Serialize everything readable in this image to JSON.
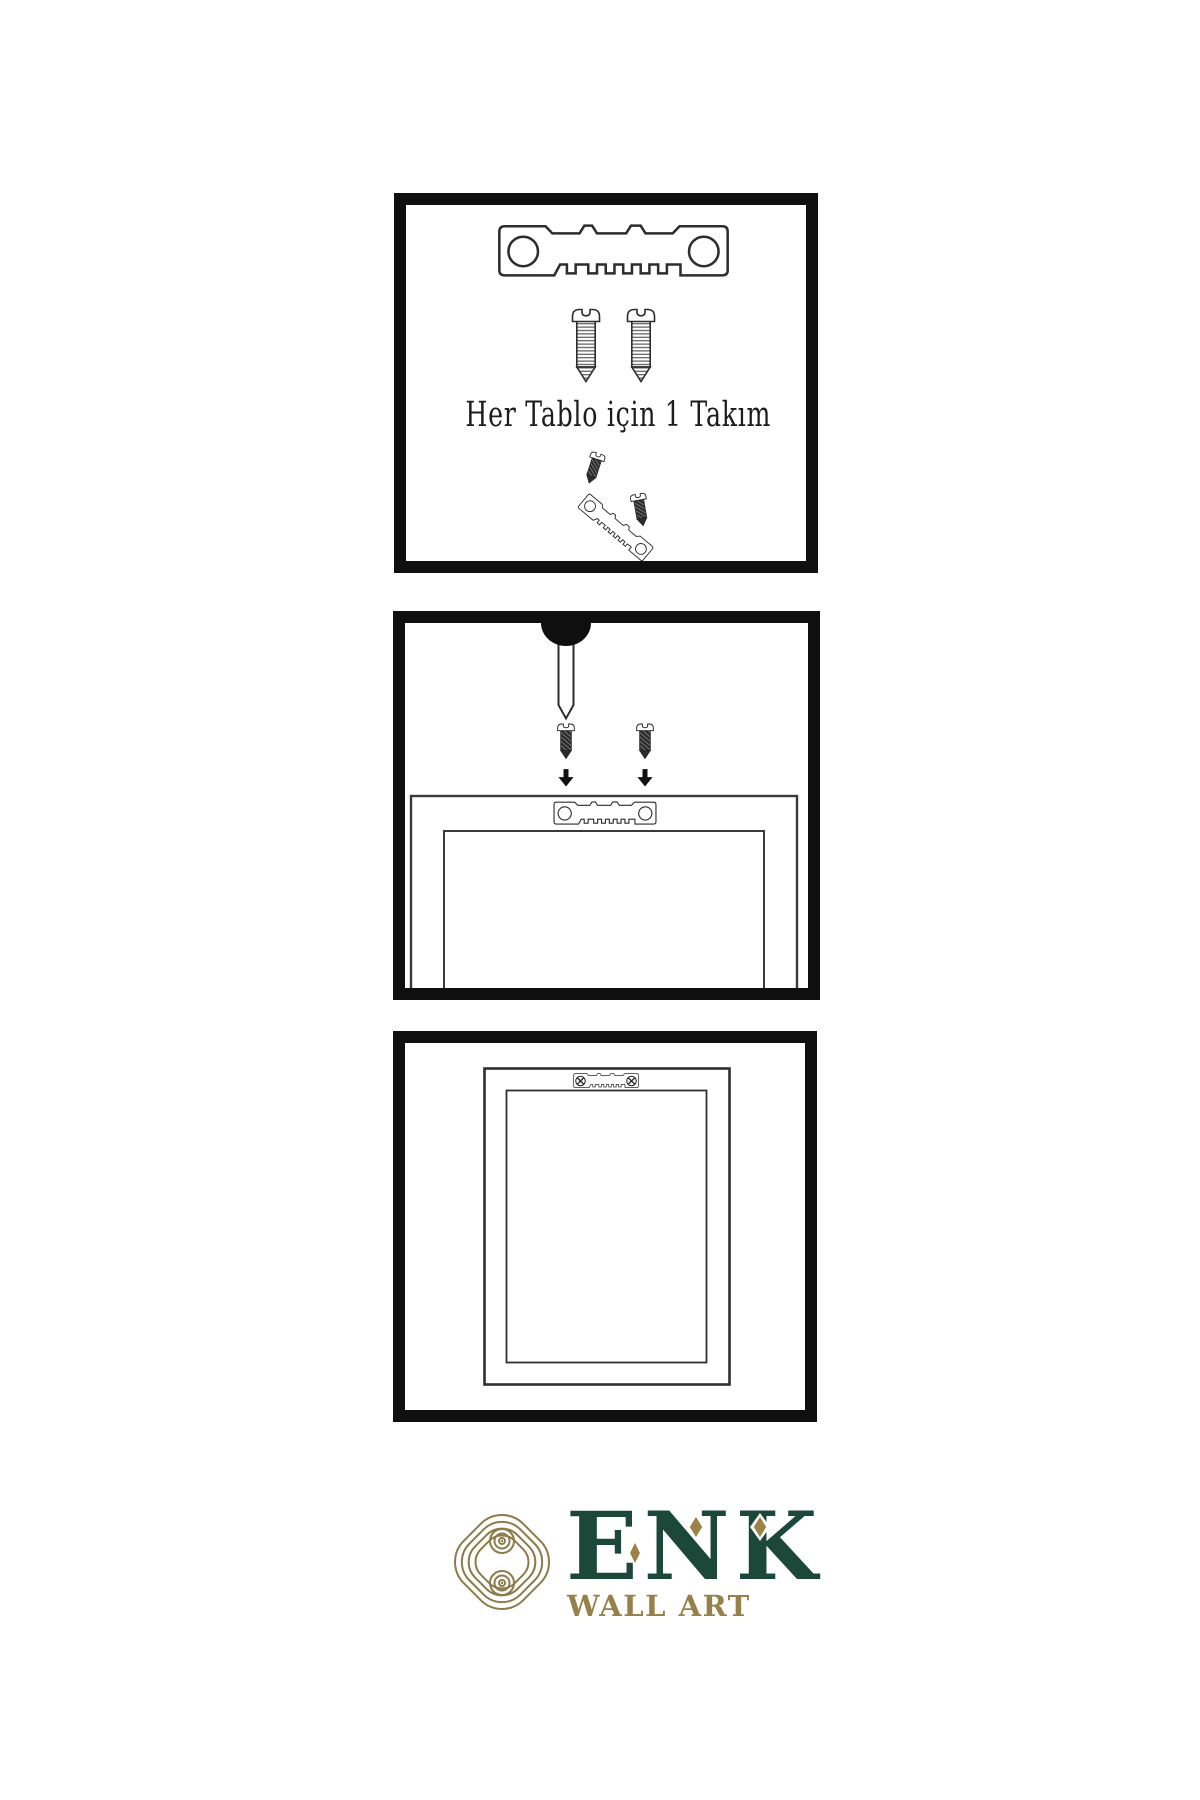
{
  "document": {
    "type": "wall-art-hanging-instructions",
    "background": "#ffffff",
    "line_color": "#2d2d2d",
    "border_color": "#0f0f0f"
  },
  "steps": [
    {
      "id": 1,
      "caption": "Her Tablo için 1 Takım",
      "illustrations": [
        "sawtooth-hanger",
        "screw",
        "screw",
        "screw-angled",
        "sawtooth-hanger-tilted",
        "screw-angled"
      ]
    },
    {
      "id": 2,
      "caption": "",
      "illustrations": [
        "wall-nail",
        "dark-screw",
        "dark-screw",
        "arrow-down",
        "arrow-down",
        "frame-back-outline",
        "sawtooth-hanger-on-frame"
      ]
    },
    {
      "id": 3,
      "caption": "",
      "illustrations": [
        "hung-frame-outline",
        "mounted-sawtooth-hanger",
        "crosshead-screw",
        "crosshead-screw"
      ]
    }
  ],
  "logo": {
    "brand": "ENK",
    "subtitle": "WALL ART",
    "symbol": "interlocking-knot",
    "colors": {
      "green": "#1c4839",
      "gold": "#97814a",
      "knot_gold": "#8d7b49",
      "diamond_gold": "#9d8245"
    }
  }
}
